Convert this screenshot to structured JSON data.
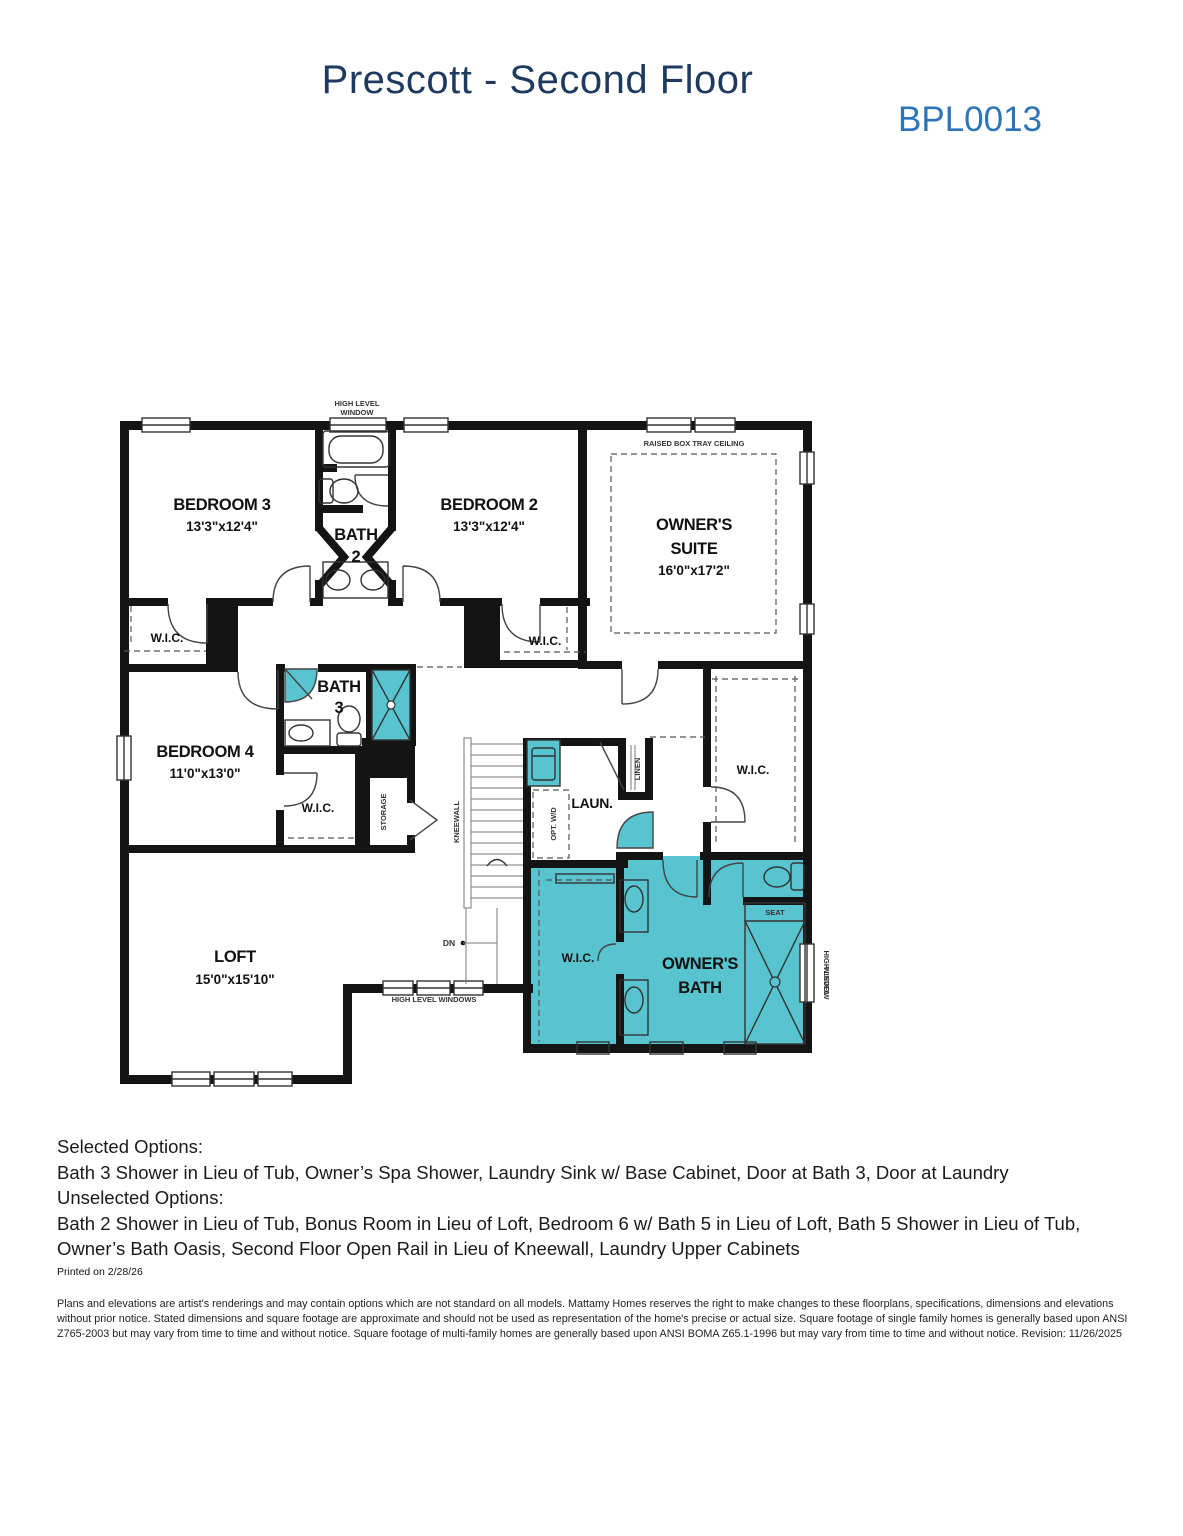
{
  "page": {
    "title": "Prescott - Second Floor",
    "plan_code": "BPL0013"
  },
  "colors": {
    "teal": "#57c4cf",
    "title_navy": "#1e3a5f",
    "code_blue": "#2d74b8",
    "wall_black": "#141414"
  },
  "floorplan": {
    "rooms": {
      "bedroom3": {
        "name": "BEDROOM 3",
        "dims": "13'3\"x12'4\""
      },
      "bedroom2": {
        "name": "BEDROOM 2",
        "dims": "13'3\"x12'4\""
      },
      "owners_suite": {
        "name_1": "OWNER'S",
        "name_2": "SUITE",
        "dims": "16'0\"x17'2\""
      },
      "bedroom4": {
        "name": "BEDROOM 4",
        "dims": "11'0\"x13'0\""
      },
      "loft": {
        "name": "LOFT",
        "dims": "15'0\"x15'10\""
      },
      "bath2": {
        "name_1": "BATH",
        "name_2": "2"
      },
      "bath3": {
        "name_1": "BATH",
        "name_2": "3"
      },
      "owners_bath": {
        "name_1": "OWNER'S",
        "name_2": "BATH"
      },
      "laundry": {
        "name": "LAUN."
      }
    },
    "labels": {
      "wic": "W.I.C.",
      "high_level_window_1": "HIGH LEVEL",
      "high_level_window_2": "WINDOW",
      "high_level_windows": "HIGH LEVEL WINDOWS",
      "raised_box_tray_ceiling": "RAISED BOX TRAY CEILING",
      "kneewall": "KNEEWALL",
      "storage": "STORAGE",
      "linen": "LINEN",
      "opt_wd": "OPT. W/D",
      "dn": "DN",
      "seat": "SEAT"
    }
  },
  "options": {
    "selected_heading": "Selected Options:",
    "selected_items": "Bath 3 Shower in Lieu of Tub, Owner’s Spa Shower, Laundry Sink w/ Base Cabinet, Door at Bath 3, Door at Laundry",
    "unselected_heading": "Unselected Options:",
    "unselected_items": "Bath 2 Shower in Lieu of Tub, Bonus Room in Lieu of Loft, Bedroom 6 w/ Bath 5 in Lieu of Loft, Bath 5 Shower in Lieu of Tub, Owner’s Bath Oasis, Second Floor Open Rail in Lieu of Kneewall, Laundry Upper Cabinets",
    "printed": "Printed on 2/28/26"
  },
  "disclaimer": "Plans and elevations are artist's renderings and may contain options which are not standard on all models. Mattamy Homes reserves the right to make changes to these floorplans, specifications, dimensions and elevations without prior notice. Stated dimensions and square footage are approximate and should not be used as representation of the home's precise or actual size. Square footage of single family homes is generally based upon ANSI Z765-2003 but may vary from time to time and without notice. Square footage of multi-family homes are generally based upon ANSI BOMA Z65.1-1996 but may vary from time to time and without notice. Revision: 11/26/2025"
}
